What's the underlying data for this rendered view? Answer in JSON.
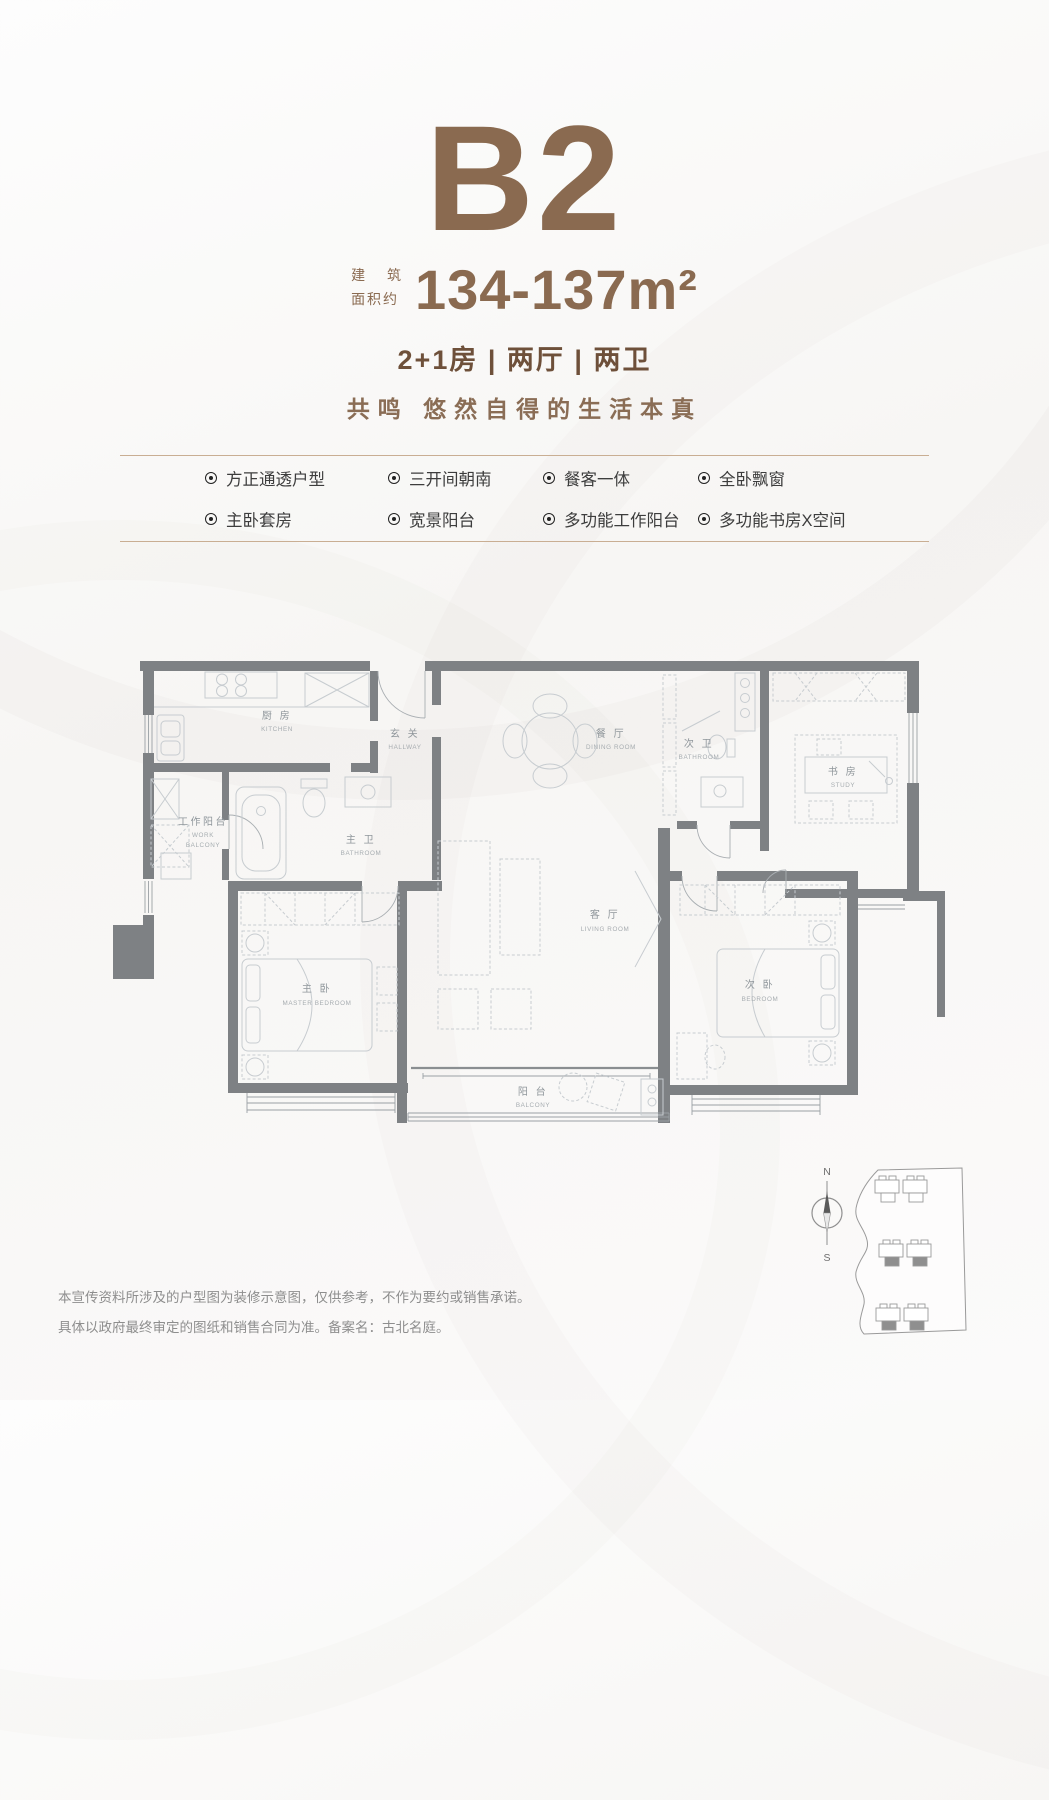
{
  "header": {
    "unit_name": "B2",
    "area_prefix_line1": "建 筑",
    "area_prefix_line2": "面积约",
    "area_value": "134-137m²",
    "layout_spec": "2+1房 | 两厅 | 两卫",
    "slogan": "共鸣  悠然自得的生活本真"
  },
  "features": {
    "items": [
      "方正通透户型",
      "三开间朝南",
      "餐客一体",
      "全卧飘窗",
      "主卧套房",
      "宽景阳台",
      "多功能工作阳台",
      "多功能书房X空间"
    ]
  },
  "floorplan": {
    "rooms": {
      "kitchen": {
        "cn": "厨 房",
        "en": "KITCHEN"
      },
      "hallway": {
        "cn": "玄 关",
        "en": "HALLWAY"
      },
      "dining": {
        "cn": "餐 厅",
        "en": "DINING ROOM"
      },
      "bath2": {
        "cn": "次 卫",
        "en": "BATHROOM"
      },
      "study": {
        "cn": "书 房",
        "en": "STUDY"
      },
      "work_balcony": {
        "cn": "工作阳台",
        "en1": "WORK",
        "en2": "BALCONY"
      },
      "bath1": {
        "cn": "主 卫",
        "en": "BATHROOM"
      },
      "master": {
        "cn": "主 卧",
        "en": "MASTER BEDROOM"
      },
      "living": {
        "cn": "客 厅",
        "en": "LIVING ROOM"
      },
      "bedroom2": {
        "cn": "次 卧",
        "en": "BEDROOM"
      },
      "balcony": {
        "cn": "阳 台",
        "en": "BALCONY"
      }
    }
  },
  "compass": {
    "north": "N",
    "south": "S"
  },
  "footer": {
    "disclaimer_line1": "本宣传资料所涉及的户型图为装修示意图，仅供参考，不作为要约或销售承诺。",
    "disclaimer_line2": "具体以政府最终审定的图纸和销售合同为准。备案名：古北名庭。"
  },
  "colors": {
    "accent_brown": "#8a6a50",
    "divider": "#c9ae93",
    "wall_gray": "#7e8184"
  }
}
